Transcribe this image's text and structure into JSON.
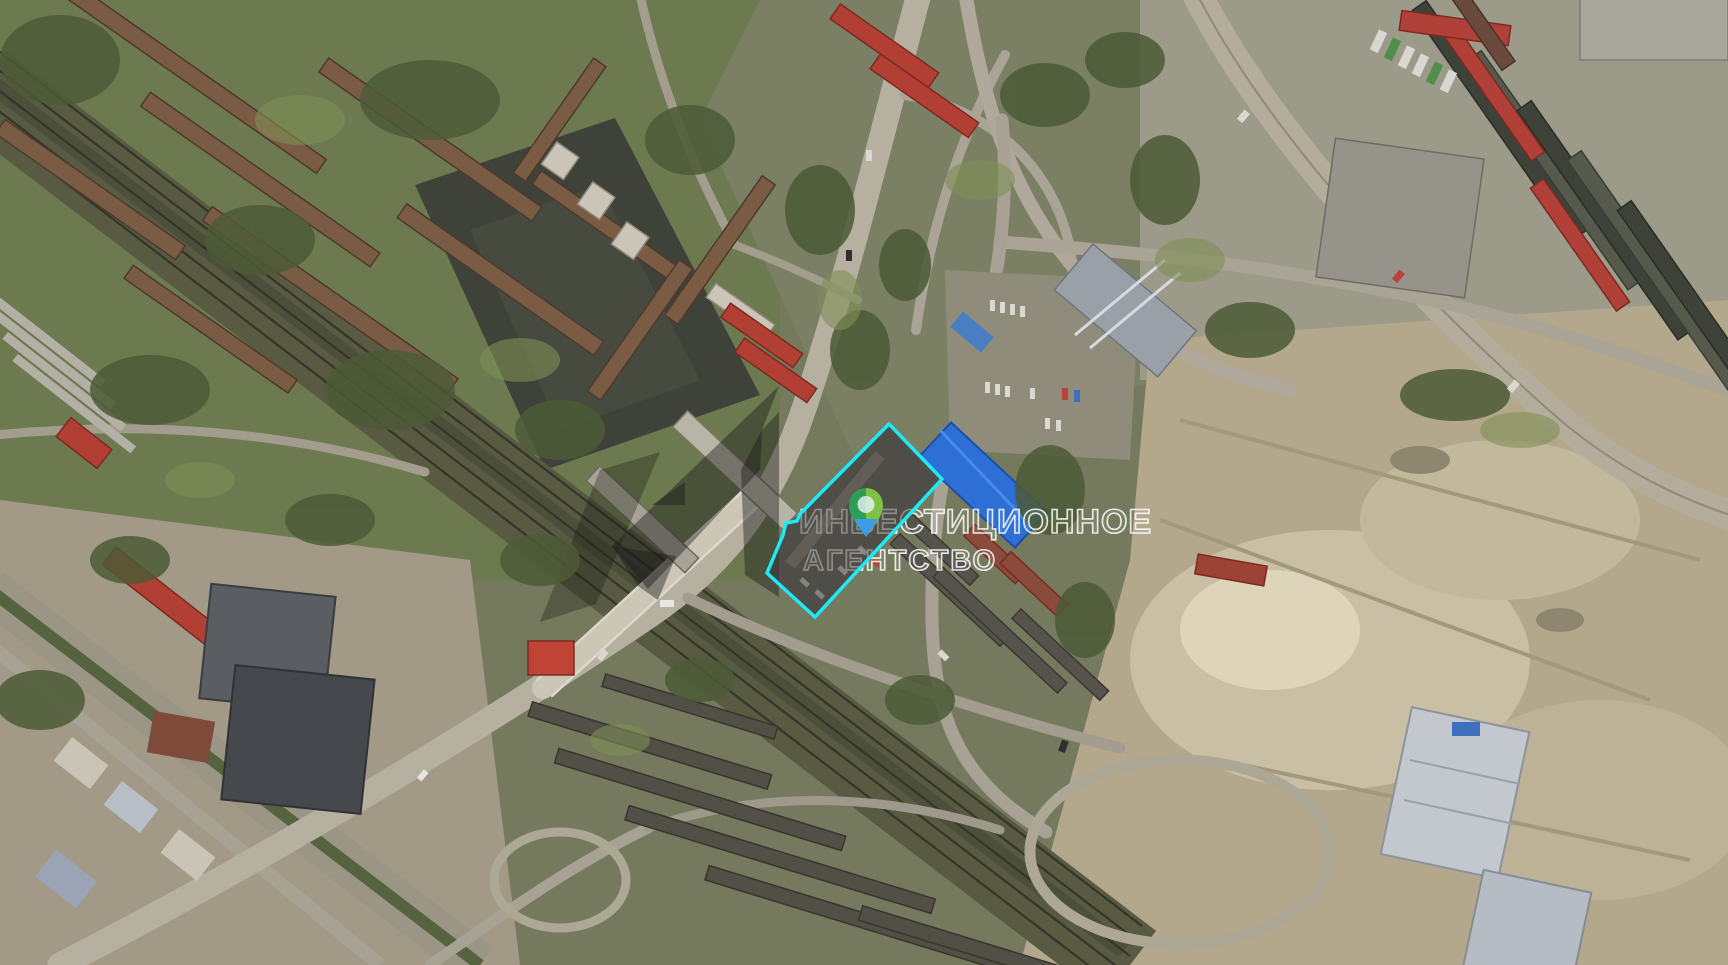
{
  "map": {
    "kind": "satellite-aerial-view"
  },
  "watermark": {
    "line1": "ИНВЕСТИЦИОННОЕ",
    "line2": "АГЕНТСТВО",
    "text_color": "#ffffff",
    "logo_color": "rgba(25,25,25,0.42)"
  },
  "parcel": {
    "outline_color": "#1FE9F6",
    "stroke_width": "3.5",
    "vertices": "889,424 800,514 797,521 786,523 783,535 767,573 815,617 942,479",
    "fill": "rgba(70,68,62,0.55)"
  },
  "marker": {
    "transform": "translate(848,487)",
    "ring_left_color": "#2E9E57",
    "ring_right_color": "#7DC243",
    "tip_color": "#3E9BE9",
    "hole_color": "rgba(235,245,250,0.78)"
  }
}
